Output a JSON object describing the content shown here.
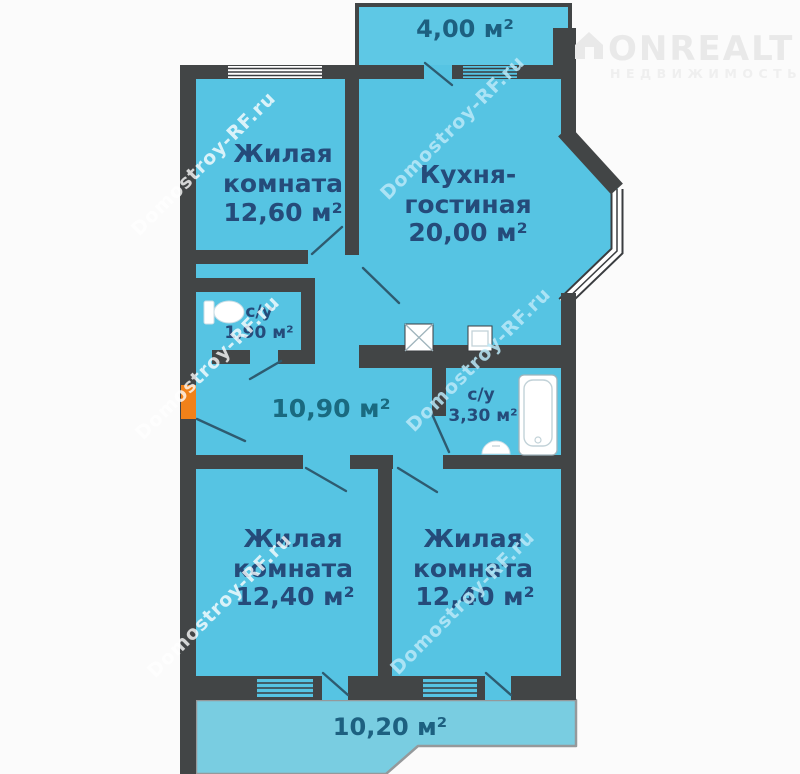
{
  "watermark": {
    "text": "Domostroy-RF.ru"
  },
  "logo": {
    "title": "ONREALT",
    "subtitle": "НЕДВИЖИМОСТЬ"
  },
  "colors": {
    "room_fill": "#56c4e3",
    "balcony_fill": "#79cde1",
    "wall": "#424546",
    "label_blue": "#254b7a",
    "hall_teal": "#1a6a80",
    "entrance_orange": "#f08119",
    "watermark_blue": "#bae9f8",
    "logo_gray": "#e9e9e9"
  },
  "rooms": {
    "balcony_top": {
      "area": "4,00 м²"
    },
    "living1": {
      "name1": "Жилая",
      "name2": "комната",
      "area": "12,60 м²"
    },
    "kitchen": {
      "name1": "Кухня-",
      "name2": "гостиная",
      "area": "20,00 м²"
    },
    "wc1": {
      "name": "с/у",
      "area": "1,90 м²"
    },
    "hall": {
      "area": "10,90 м²"
    },
    "wc2": {
      "name": "с/у",
      "area": "3,30 м²"
    },
    "living2": {
      "name1": "Жилая",
      "name2": "комната",
      "area": "12,40 м²"
    },
    "living3": {
      "name1": "Жилая",
      "name2": "комната",
      "area": "12,40 м²"
    },
    "balcony_bottom": {
      "area": "10,20 м²"
    }
  }
}
